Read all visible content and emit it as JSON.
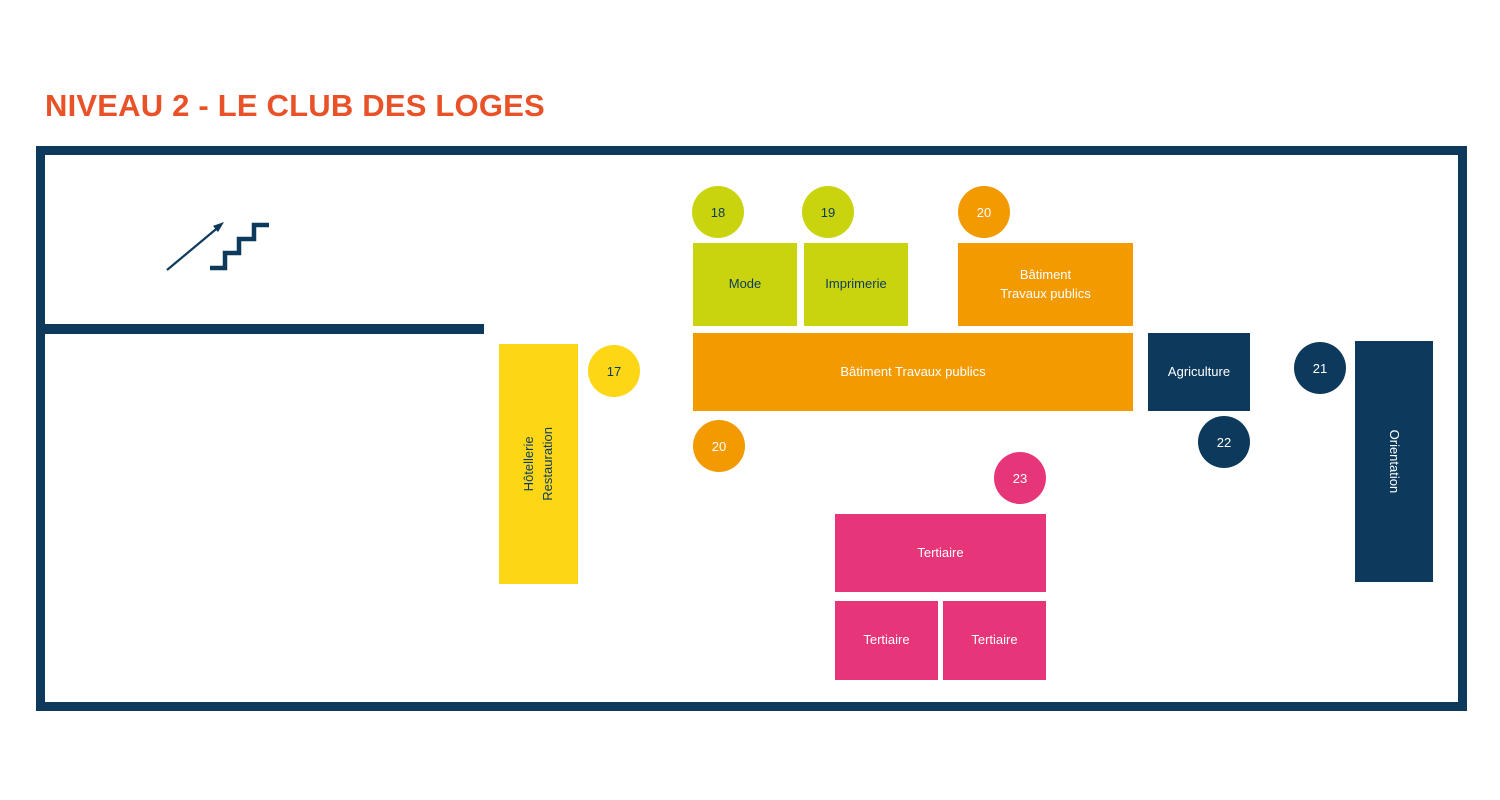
{
  "title": "NIVEAU 2 - LE CLUB DES LOGES",
  "colors": {
    "title_orange": "#e95228",
    "navy": "#0d3a5c",
    "lime": "#c9d40f",
    "orange": "#f39a00",
    "yellow": "#fdd716",
    "pink": "#e73579",
    "white": "#ffffff"
  },
  "plan": {
    "zones": [
      {
        "name": "hotellerie-restauration",
        "label": "Hôtellerie\nRestauration",
        "color": "#fdd716"
      },
      {
        "name": "mode",
        "label": "Mode",
        "color": "#c9d40f"
      },
      {
        "name": "imprimerie",
        "label": "Imprimerie",
        "color": "#c9d40f"
      },
      {
        "name": "batiment-travaux-publics-small",
        "label": "Bâtiment\nTravaux publics",
        "color": "#f39a00"
      },
      {
        "name": "batiment-travaux-publics-large",
        "label": "Bâtiment Travaux publics",
        "color": "#f39a00"
      },
      {
        "name": "agriculture",
        "label": "Agriculture",
        "color": "#0d3a5c"
      },
      {
        "name": "orientation",
        "label": "Orientation",
        "color": "#0d3a5c"
      },
      {
        "name": "tertiaire-large",
        "label": "Tertiaire",
        "color": "#e73579"
      },
      {
        "name": "tertiaire-left",
        "label": "Tertiaire",
        "color": "#e73579"
      },
      {
        "name": "tertiaire-right",
        "label": "Tertiaire",
        "color": "#e73579"
      }
    ],
    "badges": [
      {
        "number": "17",
        "color": "#fdd716"
      },
      {
        "number": "18",
        "color": "#c9d40f"
      },
      {
        "number": "19",
        "color": "#c9d40f"
      },
      {
        "number": "20",
        "color": "#f39a00"
      },
      {
        "number": "20",
        "color": "#f39a00"
      },
      {
        "number": "21",
        "color": "#0d3a5c"
      },
      {
        "number": "22",
        "color": "#0d3a5c"
      },
      {
        "number": "23",
        "color": "#e73579"
      }
    ]
  }
}
